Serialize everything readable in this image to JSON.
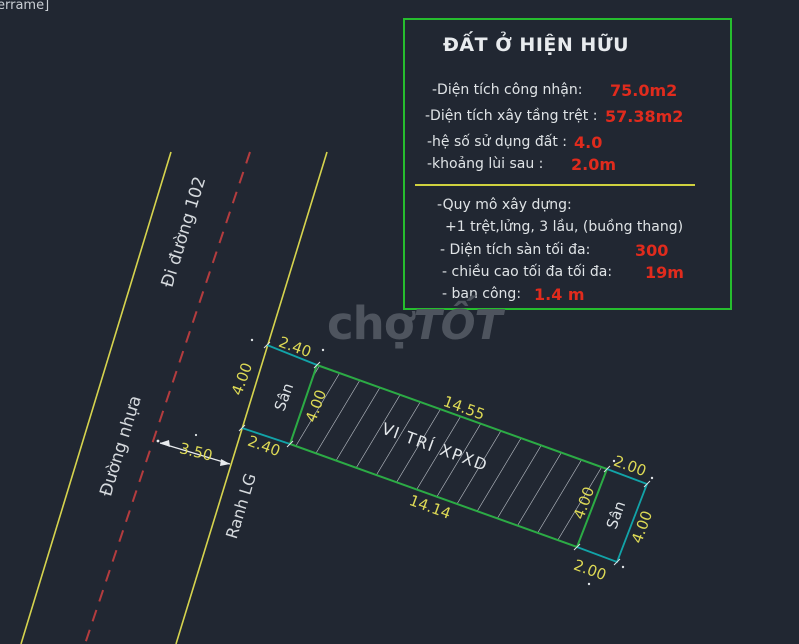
{
  "viewport_label": "errame]",
  "watermark": {
    "part1": "chợ",
    "part2": "TỐT"
  },
  "info_box": {
    "title": "ĐẤT Ở HIỆN HỮU",
    "rows": [
      {
        "label": "-Diện tích công nhận:",
        "value": "75.0m2"
      },
      {
        "label": "-Diện tích xây tầng trệt :",
        "value": "57.38m2"
      },
      {
        "label": "-hệ số sử dụng đất :",
        "value": "4.0"
      },
      {
        "label": "-khoảng lùi sau :",
        "value": "2.0m"
      },
      {
        "label": "-Quy mô xây dựng:",
        "value": ""
      },
      {
        "label": "+1 trệt,lửng, 3 lầu, (buồng thang)",
        "value": ""
      },
      {
        "label": "- Diện tích sàn tối đa:",
        "value": "300"
      },
      {
        "label": "- chiều cao tối đa tối đa:",
        "value": "19m"
      },
      {
        "label": "- ban công:",
        "value": "1.4 m"
      }
    ]
  },
  "drawing": {
    "road_name": "Đi đường 102",
    "road_surface": "Đường nhựa",
    "boundary_label": "Ranh LG",
    "labels": {
      "front_yard": "Sân",
      "back_yard": "Sân",
      "build_area": "VI TRÍ XPXD"
    },
    "dims": {
      "road_offset": "3.50",
      "front_width_top": "2.40",
      "front_depth": "4.00",
      "front_width_bottom": "2.40",
      "build_left": "4.00",
      "build_top": "14.55",
      "build_bottom": "14.14",
      "build_right": "4.00",
      "back_width_top": "2.00",
      "back_depth": "4.00",
      "back_width_bottom": "2.00"
    }
  },
  "colors": {
    "background": "#212732",
    "road_line_yellow": "#d6d44e",
    "centerline_red": "#b43c3e",
    "plot_green": "#2cab45",
    "yard_cyan": "#12a3a8",
    "hatch_white": "#ccd1d8",
    "dim_text_yellow": "#ddd955",
    "info_border_green": "#26bd2e",
    "value_red": "#e02b1d",
    "watermark_gray": "#4e545e"
  }
}
